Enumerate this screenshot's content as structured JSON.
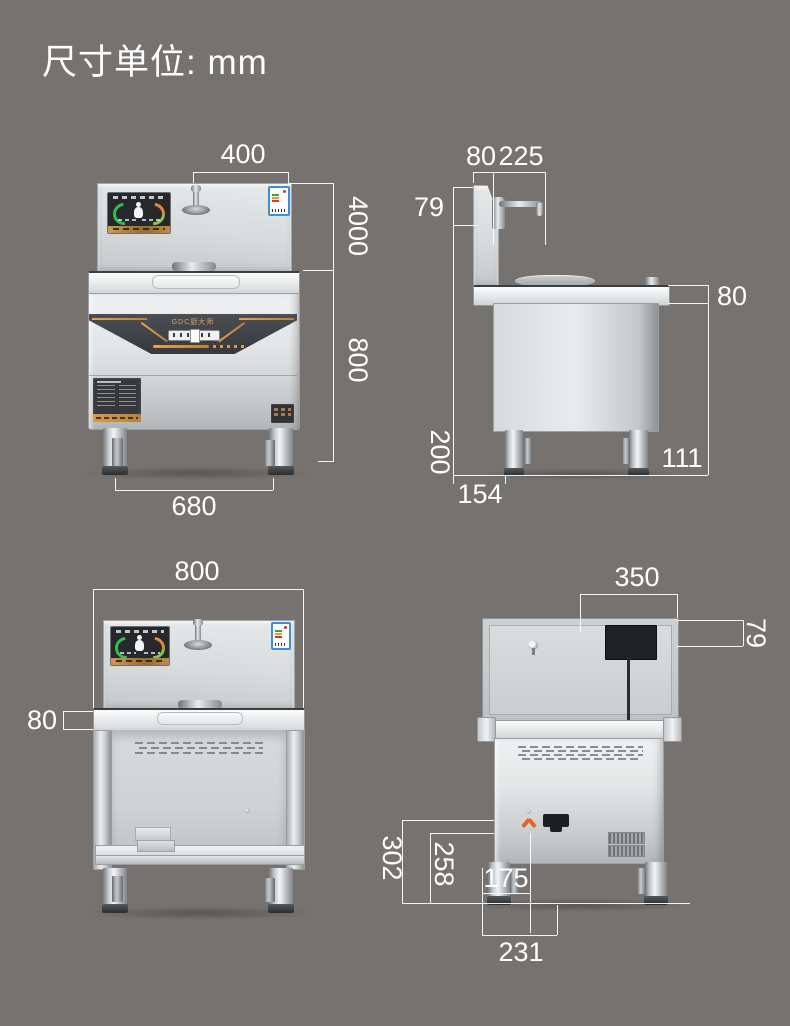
{
  "title": "尺寸单位: mm",
  "brand": "GDC厨大师",
  "colors": {
    "background": "#767270",
    "dimension_line": "#ffffff",
    "accent_orange": "#d4873f",
    "steel_light": "#eceeef",
    "steel_dark": "#b9bcbe",
    "control_band": "#3d4045",
    "energy_label_blue": "#3f8fd6"
  },
  "views": {
    "front": {
      "top_width": "400",
      "backsplash_height": "4000",
      "body_height": "800",
      "legs_width": "680"
    },
    "side": {
      "backsplash_depth": "80",
      "faucet_reach": "225",
      "faucet_height": "79",
      "countertop_thickness": "80",
      "leg_height": "200",
      "front_offset": "154",
      "rear_offset": "111"
    },
    "stand": {
      "top_width": "800",
      "countertop_thickness": "80"
    },
    "rear": {
      "top_width": "350",
      "box_height": "79",
      "height_outer": "302",
      "height_inner": "258",
      "width_inner": "175",
      "width_bottom": "231"
    }
  }
}
